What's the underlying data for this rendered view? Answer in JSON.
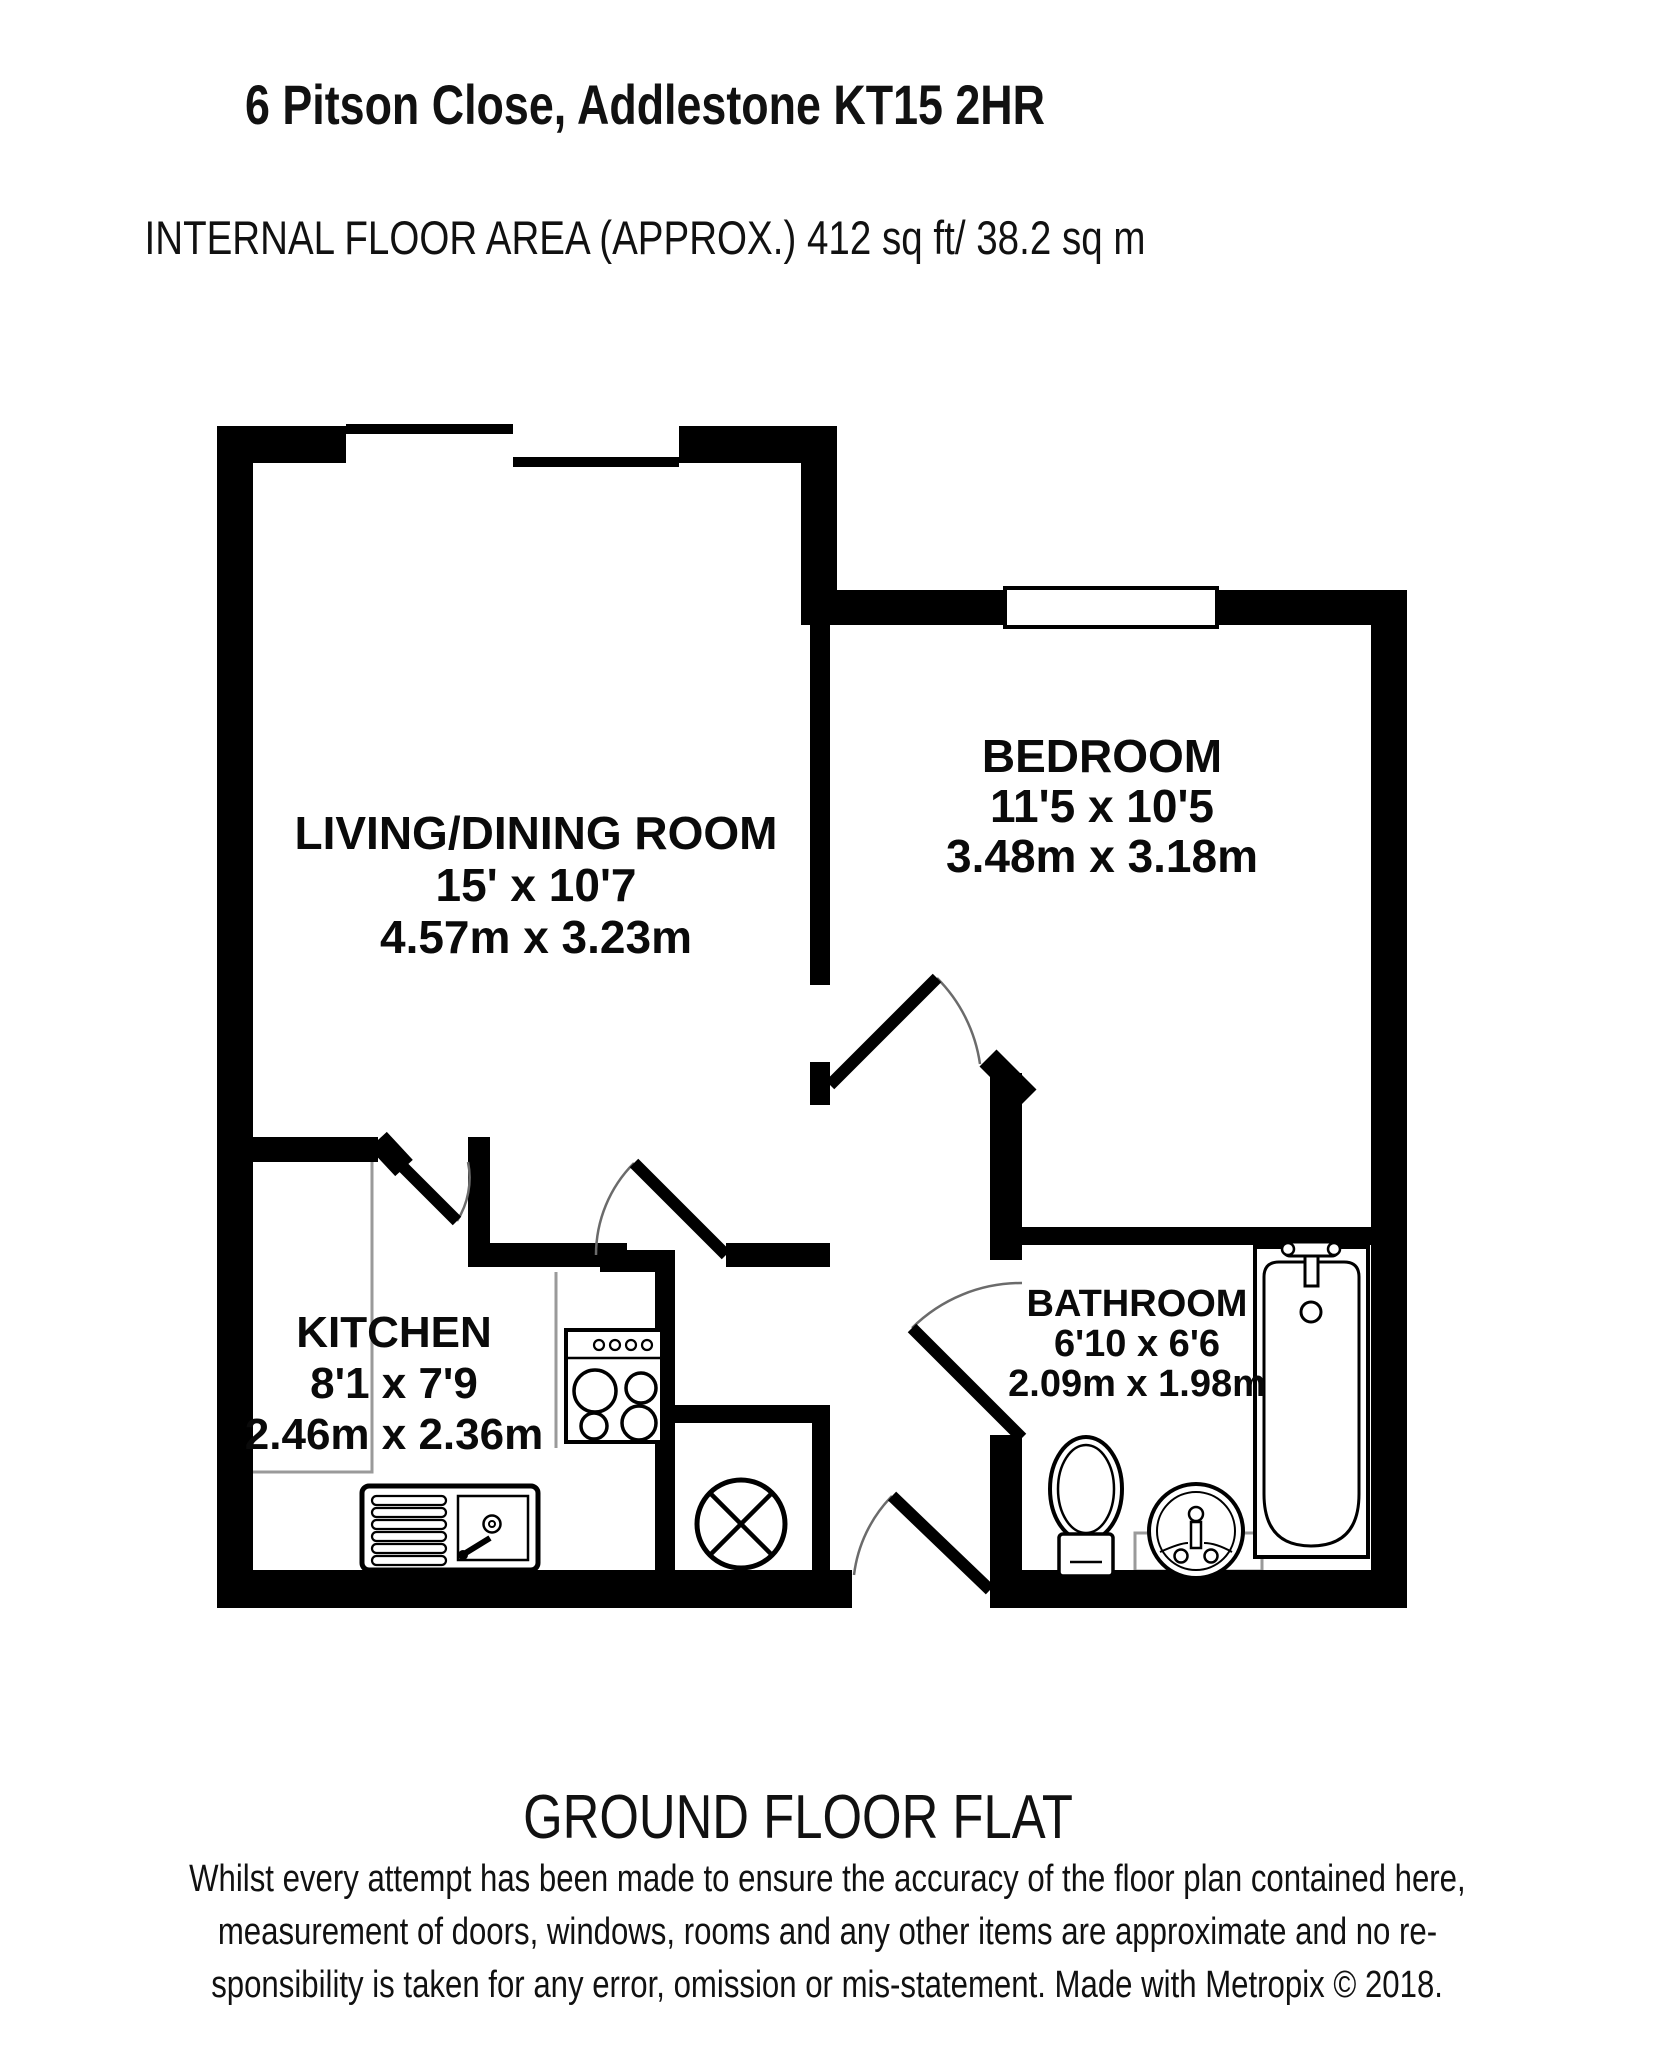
{
  "header": {
    "title": "6 Pitson Close, Addlestone KT15 2HR",
    "subtitle": "INTERNAL FLOOR AREA (APPROX.) 412 sq ft/ 38.2 sq m"
  },
  "footer": {
    "floor_label": "GROUND FLOOR FLAT",
    "disclaimer_lines": [
      "Whilst every attempt has been made to ensure the accuracy of the floor plan contained here,",
      "measurement of doors, windows, rooms and any other items are approximate and no re-",
      "sponsibility is taken for any error, omission or mis-statement. Made with Metropix © 2018."
    ]
  },
  "colors": {
    "wall": "#000000",
    "door_arc": "#6b6b6b",
    "counter": "#9a9a9a",
    "fixture": "#000000"
  },
  "rooms": [
    {
      "name": "LIVING/DINING ROOM",
      "dims_imperial": "15' x 10'7",
      "dims_metric": "4.57m x 3.23m",
      "pos": {
        "cx": 536,
        "top": 807,
        "font": 46,
        "lh": 52
      }
    },
    {
      "name": "BEDROOM",
      "dims_imperial": "11'5 x 10'5",
      "dims_metric": "3.48m x 3.18m",
      "pos": {
        "cx": 1102,
        "top": 731,
        "font": 46,
        "lh": 50
      }
    },
    {
      "name": "KITCHEN",
      "dims_imperial": "8'1 x 7'9",
      "dims_metric": "2.46m x 2.36m",
      "pos": {
        "cx": 394,
        "top": 1307,
        "font": 44,
        "lh": 51
      }
    },
    {
      "name": "BATHROOM",
      "dims_imperial": "6'10 x 6'6",
      "dims_metric": "2.09m x 1.98m",
      "pos": {
        "cx": 1137,
        "top": 1284,
        "font": 38,
        "lh": 40
      }
    }
  ],
  "plan": {
    "shapes": [
      {
        "n": "kitchen-counter-line",
        "t": "path",
        "d": "M372,1162 L372,1472 L253,1472",
        "st": "#9a9a9a",
        "sw": 3
      },
      {
        "n": "kitchen-counter-line",
        "t": "line",
        "x1": 556,
        "y1": 1272,
        "x2": 556,
        "y2": 1448,
        "st": "#9a9a9a",
        "sw": 3
      },
      {
        "n": "bathroom-vanity-line",
        "t": "rect",
        "x": 1135,
        "y": 1533,
        "w": 127,
        "h": 38,
        "st": "#9a9a9a",
        "sw": 3,
        "fill": "none"
      },
      {
        "n": "wall",
        "t": "rect",
        "x": 217,
        "y": 426,
        "w": 36,
        "h": 1182,
        "fill": "#000"
      },
      {
        "n": "wall",
        "t": "rect",
        "x": 217,
        "y": 426,
        "w": 129,
        "h": 37,
        "fill": "#000"
      },
      {
        "n": "wall",
        "t": "rect",
        "x": 679,
        "y": 426,
        "w": 158,
        "h": 37,
        "fill": "#000"
      },
      {
        "n": "wall",
        "t": "rect",
        "x": 801,
        "y": 463,
        "w": 36,
        "h": 162,
        "fill": "#000"
      },
      {
        "n": "wall",
        "t": "rect",
        "x": 801,
        "y": 590,
        "w": 204,
        "h": 35,
        "fill": "#000"
      },
      {
        "n": "wall",
        "t": "rect",
        "x": 1217,
        "y": 590,
        "w": 190,
        "h": 35,
        "fill": "#000"
      },
      {
        "n": "wall",
        "t": "rect",
        "x": 1371,
        "y": 590,
        "w": 36,
        "h": 1018,
        "fill": "#000"
      },
      {
        "n": "wall",
        "t": "rect",
        "x": 217,
        "y": 1570,
        "w": 635,
        "h": 38,
        "fill": "#000"
      },
      {
        "n": "wall",
        "t": "rect",
        "x": 990,
        "y": 1570,
        "w": 417,
        "h": 38,
        "fill": "#000"
      },
      {
        "n": "wall",
        "t": "rect",
        "x": 810,
        "y": 625,
        "w": 20,
        "h": 360,
        "fill": "#000"
      },
      {
        "n": "wall",
        "t": "rect",
        "x": 810,
        "y": 1062,
        "w": 20,
        "h": 43,
        "fill": "#000"
      },
      {
        "n": "wall",
        "t": "rect",
        "x": 990,
        "y": 1073,
        "w": 32,
        "h": 187,
        "fill": "#000"
      },
      {
        "n": "wall",
        "t": "rect",
        "x": 990,
        "y": 1435,
        "w": 32,
        "h": 135,
        "fill": "#000"
      },
      {
        "n": "wall",
        "t": "rect",
        "x": 1022,
        "y": 1227,
        "w": 349,
        "h": 18,
        "fill": "#000"
      },
      {
        "n": "wall",
        "t": "rect",
        "x": 253,
        "y": 1137,
        "w": 125,
        "h": 25,
        "fill": "#000"
      },
      {
        "n": "wall",
        "t": "rect",
        "x": 468,
        "y": 1137,
        "w": 22,
        "h": 130,
        "fill": "#000"
      },
      {
        "n": "wall",
        "t": "rect",
        "x": 490,
        "y": 1243,
        "w": 137,
        "h": 24,
        "fill": "#000"
      },
      {
        "n": "wall",
        "t": "rect",
        "x": 726,
        "y": 1243,
        "w": 104,
        "h": 24,
        "fill": "#000"
      },
      {
        "n": "wall",
        "t": "rect",
        "x": 600,
        "y": 1250,
        "w": 75,
        "h": 22,
        "fill": "#000"
      },
      {
        "n": "wall",
        "t": "rect",
        "x": 655,
        "y": 1267,
        "w": 20,
        "h": 303,
        "fill": "#000"
      },
      {
        "n": "wall",
        "t": "rect",
        "x": 675,
        "y": 1405,
        "w": 155,
        "h": 18,
        "fill": "#000"
      },
      {
        "n": "wall",
        "t": "rect",
        "x": 812,
        "y": 1405,
        "w": 18,
        "h": 165,
        "fill": "#000"
      },
      {
        "n": "wall-diagonal",
        "t": "line",
        "x1": 988,
        "y1": 1058,
        "x2": 1028,
        "y2": 1098,
        "st": "#000",
        "sw": 24
      },
      {
        "n": "wall-diagonal",
        "t": "line",
        "x1": 378,
        "y1": 1140,
        "x2": 404,
        "y2": 1168,
        "st": "#000",
        "sw": 24
      },
      {
        "n": "window-sill",
        "t": "rect",
        "x": 346,
        "y": 424,
        "w": 167,
        "h": 10,
        "fill": "#000"
      },
      {
        "n": "window-sill",
        "t": "rect",
        "x": 513,
        "y": 457,
        "w": 166,
        "h": 10,
        "fill": "#000"
      },
      {
        "n": "bedroom-window",
        "t": "rect",
        "x": 1005,
        "y": 588,
        "w": 212,
        "h": 39,
        "fill": "#fff",
        "st": "#000",
        "sw": 4
      },
      {
        "n": "stove",
        "t": "rect",
        "x": 566,
        "y": 1330,
        "w": 96,
        "h": 112,
        "fill": "#fff",
        "st": "#000",
        "sw": 4
      },
      {
        "n": "stove-panel-line",
        "t": "line",
        "x1": 566,
        "y1": 1358,
        "x2": 662,
        "y2": 1358,
        "st": "#000",
        "sw": 2.5
      },
      {
        "n": "stove-knob",
        "t": "circle",
        "cx": 599,
        "cy": 1345,
        "r": 5,
        "st": "#000",
        "sw": 2.2,
        "fill": "none"
      },
      {
        "n": "stove-knob",
        "t": "circle",
        "cx": 615,
        "cy": 1345,
        "r": 5,
        "st": "#000",
        "sw": 2.2,
        "fill": "none"
      },
      {
        "n": "stove-knob",
        "t": "circle",
        "cx": 631,
        "cy": 1345,
        "r": 5,
        "st": "#000",
        "sw": 2.2,
        "fill": "none"
      },
      {
        "n": "stove-knob",
        "t": "circle",
        "cx": 647,
        "cy": 1345,
        "r": 5,
        "st": "#000",
        "sw": 2.2,
        "fill": "none"
      },
      {
        "n": "stove-burner",
        "t": "circle",
        "cx": 595,
        "cy": 1391,
        "r": 21,
        "st": "#000",
        "sw": 3.5,
        "fill": "none"
      },
      {
        "n": "stove-burner",
        "t": "circle",
        "cx": 641,
        "cy": 1388,
        "r": 15,
        "st": "#000",
        "sw": 3.5,
        "fill": "none"
      },
      {
        "n": "stove-burner",
        "t": "circle",
        "cx": 594,
        "cy": 1426,
        "r": 13,
        "st": "#000",
        "sw": 3.5,
        "fill": "none"
      },
      {
        "n": "stove-burner",
        "t": "circle",
        "cx": 639,
        "cy": 1423,
        "r": 17,
        "st": "#000",
        "sw": 3.5,
        "fill": "none"
      },
      {
        "n": "sink-unit",
        "t": "rect",
        "x": 362,
        "y": 1486,
        "w": 176,
        "h": 84,
        "rx": 7,
        "fill": "#fff",
        "st": "#000",
        "sw": 5
      },
      {
        "n": "sink-drainer-bar",
        "t": "rect",
        "x": 372,
        "y": 1496,
        "w": 74,
        "h": 9,
        "rx": 4.5,
        "st": "#000",
        "sw": 2.2,
        "fill": "none"
      },
      {
        "n": "sink-drainer-bar",
        "t": "rect",
        "x": 372,
        "y": 1508,
        "w": 74,
        "h": 9,
        "rx": 4.5,
        "st": "#000",
        "sw": 2.2,
        "fill": "none"
      },
      {
        "n": "sink-drainer-bar",
        "t": "rect",
        "x": 372,
        "y": 1520,
        "w": 74,
        "h": 9,
        "rx": 4.5,
        "st": "#000",
        "sw": 2.2,
        "fill": "none"
      },
      {
        "n": "sink-drainer-bar",
        "t": "rect",
        "x": 372,
        "y": 1532,
        "w": 74,
        "h": 9,
        "rx": 4.5,
        "st": "#000",
        "sw": 2.2,
        "fill": "none"
      },
      {
        "n": "sink-drainer-bar",
        "t": "rect",
        "x": 372,
        "y": 1544,
        "w": 74,
        "h": 9,
        "rx": 4.5,
        "st": "#000",
        "sw": 2.2,
        "fill": "none"
      },
      {
        "n": "sink-drainer-bar",
        "t": "rect",
        "x": 372,
        "y": 1556,
        "w": 74,
        "h": 9,
        "rx": 4.5,
        "st": "#000",
        "sw": 2.2,
        "fill": "none"
      },
      {
        "n": "sink-basin",
        "t": "rect",
        "x": 458,
        "y": 1496,
        "w": 70,
        "h": 64,
        "st": "#000",
        "sw": 2.5,
        "fill": "none"
      },
      {
        "n": "sink-plughole",
        "t": "circle",
        "cx": 492,
        "cy": 1524,
        "r": 8.5,
        "st": "#000",
        "sw": 2.5,
        "fill": "none"
      },
      {
        "n": "sink-plughole",
        "t": "circle",
        "cx": 492,
        "cy": 1524,
        "r": 3,
        "st": "#000",
        "sw": 2,
        "fill": "none"
      },
      {
        "n": "sink-tap",
        "t": "line",
        "x1": 464,
        "y1": 1554,
        "x2": 490,
        "y2": 1538,
        "st": "#000",
        "sw": 6
      },
      {
        "n": "sink-tap",
        "t": "circle",
        "cx": 463,
        "cy": 1555,
        "r": 5,
        "fill": "#000"
      },
      {
        "n": "cylinder",
        "t": "circle",
        "cx": 741,
        "cy": 1524,
        "r": 44,
        "fill": "#fff",
        "st": "#000",
        "sw": 5
      },
      {
        "n": "cylinder-cross",
        "t": "line",
        "x1": 710,
        "y1": 1493,
        "x2": 772,
        "y2": 1555,
        "st": "#000",
        "sw": 4.5
      },
      {
        "n": "cylinder-cross",
        "t": "line",
        "x1": 772,
        "y1": 1493,
        "x2": 710,
        "y2": 1555,
        "st": "#000",
        "sw": 4.5
      },
      {
        "n": "bathtub",
        "t": "rect",
        "x": 1255,
        "y": 1247,
        "w": 113,
        "h": 310,
        "fill": "#fff",
        "st": "#000",
        "sw": 4
      },
      {
        "n": "bathtub-inner",
        "t": "path",
        "d": "M1264,1277 Q1264,1262 1279,1262 L1344,1262 Q1359,1262 1359,1277 L1359,1494 Q1359,1546 1311,1546 Q1264,1546 1264,1494 Z",
        "st": "#000",
        "sw": 3,
        "fill": "none"
      },
      {
        "n": "bathtub-tap",
        "t": "rect",
        "x": 1283,
        "y": 1242,
        "w": 56,
        "h": 14,
        "rx": 7,
        "fill": "#fff",
        "st": "#000",
        "sw": 3
      },
      {
        "n": "bathtub-tap",
        "t": "circle",
        "cx": 1288,
        "cy": 1249,
        "r": 6,
        "fill": "#fff",
        "st": "#000",
        "sw": 2.5
      },
      {
        "n": "bathtub-tap",
        "t": "circle",
        "cx": 1334,
        "cy": 1249,
        "r": 6,
        "fill": "#fff",
        "st": "#000",
        "sw": 2.5
      },
      {
        "n": "bathtub-tap",
        "t": "rect",
        "x": 1305,
        "y": 1256,
        "w": 13,
        "h": 30,
        "fill": "#fff",
        "st": "#000",
        "sw": 3
      },
      {
        "n": "bathtub-plughole",
        "t": "circle",
        "cx": 1311,
        "cy": 1312,
        "r": 10,
        "st": "#000",
        "sw": 3,
        "fill": "none"
      },
      {
        "n": "toilet-bowl",
        "t": "ellipse",
        "cx": 1086,
        "cy": 1489,
        "rx": 36,
        "ry": 52,
        "fill": "#fff",
        "st": "#000",
        "sw": 4
      },
      {
        "n": "toilet-bowl-inner",
        "t": "ellipse",
        "cx": 1086,
        "cy": 1489,
        "rx": 28,
        "ry": 44,
        "st": "#000",
        "sw": 2.5,
        "fill": "none"
      },
      {
        "n": "toilet-cistern",
        "t": "rect",
        "x": 1059,
        "y": 1534,
        "w": 54,
        "h": 42,
        "rx": 4,
        "fill": "#fff",
        "st": "#000",
        "sw": 3.5
      },
      {
        "n": "toilet-cistern-line",
        "t": "line",
        "x1": 1070,
        "y1": 1562,
        "x2": 1102,
        "y2": 1562,
        "st": "#000",
        "sw": 2.5
      },
      {
        "n": "basin",
        "t": "circle",
        "cx": 1196,
        "cy": 1531,
        "r": 47,
        "fill": "#fff",
        "st": "#000",
        "sw": 4
      },
      {
        "n": "basin-inner",
        "t": "circle",
        "cx": 1196,
        "cy": 1531,
        "r": 39,
        "st": "#000",
        "sw": 2,
        "fill": "none"
      },
      {
        "n": "basin-water-line",
        "t": "path",
        "d": "M1160,1552 Q1180,1543 1188,1543",
        "st": "#000",
        "sw": 2,
        "fill": "none"
      },
      {
        "n": "basin-water-line",
        "t": "path",
        "d": "M1204,1543 Q1216,1543 1232,1552",
        "st": "#000",
        "sw": 2,
        "fill": "none"
      },
      {
        "n": "basin-tap",
        "t": "rect",
        "x": 1191,
        "y": 1522,
        "w": 10,
        "h": 26,
        "fill": "#fff",
        "st": "#000",
        "sw": 2.5
      },
      {
        "n": "basin-tap",
        "t": "circle",
        "cx": 1196,
        "cy": 1514,
        "r": 7,
        "fill": "#fff",
        "st": "#000",
        "sw": 2.5
      },
      {
        "n": "basin-tap",
        "t": "circle",
        "cx": 1181,
        "cy": 1556,
        "r": 6.5,
        "fill": "#fff",
        "st": "#000",
        "sw": 2.5
      },
      {
        "n": "basin-tap",
        "t": "circle",
        "cx": 1211,
        "cy": 1556,
        "r": 6.5,
        "fill": "#fff",
        "st": "#000",
        "sw": 2.5
      },
      {
        "n": "door-arc",
        "t": "path",
        "d": "M634,1163 A130,130 0 0 0 596,1255",
        "st": "#6b6b6b",
        "sw": 2.5,
        "fill": "none"
      },
      {
        "n": "door-leaf",
        "t": "line",
        "x1": 726,
        "y1": 1255,
        "x2": 634,
        "y2": 1163,
        "st": "#000",
        "sw": 12
      },
      {
        "n": "door-arc",
        "t": "path",
        "d": "M457,1221 A80,80 0 0 0 468,1162",
        "st": "#6b6b6b",
        "sw": 2.5,
        "fill": "none"
      },
      {
        "n": "door-leaf",
        "t": "line",
        "x1": 400,
        "y1": 1164,
        "x2": 457,
        "y2": 1221,
        "st": "#000",
        "sw": 12
      },
      {
        "n": "door-arc",
        "t": "path",
        "d": "M937,978 A152,152 0 0 1 980,1064",
        "st": "#6b6b6b",
        "sw": 2.5,
        "fill": "none"
      },
      {
        "n": "door-leaf",
        "t": "line",
        "x1": 830,
        "y1": 1085,
        "x2": 937,
        "y2": 978,
        "st": "#000",
        "sw": 12
      },
      {
        "n": "door-arc",
        "t": "path",
        "d": "M912,1328 A155,155 0 0 1 1022,1283",
        "st": "#6b6b6b",
        "sw": 2.5,
        "fill": "none"
      },
      {
        "n": "door-leaf",
        "t": "line",
        "x1": 1022,
        "y1": 1438,
        "x2": 912,
        "y2": 1328,
        "st": "#000",
        "sw": 12
      },
      {
        "n": "door-arc",
        "t": "path",
        "d": "M892,1496 A136,136 0 0 0 854,1575",
        "st": "#6b6b6b",
        "sw": 2.5,
        "fill": "none"
      },
      {
        "n": "door-leaf",
        "t": "line",
        "x1": 990,
        "y1": 1590,
        "x2": 892,
        "y2": 1496,
        "st": "#000",
        "sw": 12
      }
    ]
  }
}
